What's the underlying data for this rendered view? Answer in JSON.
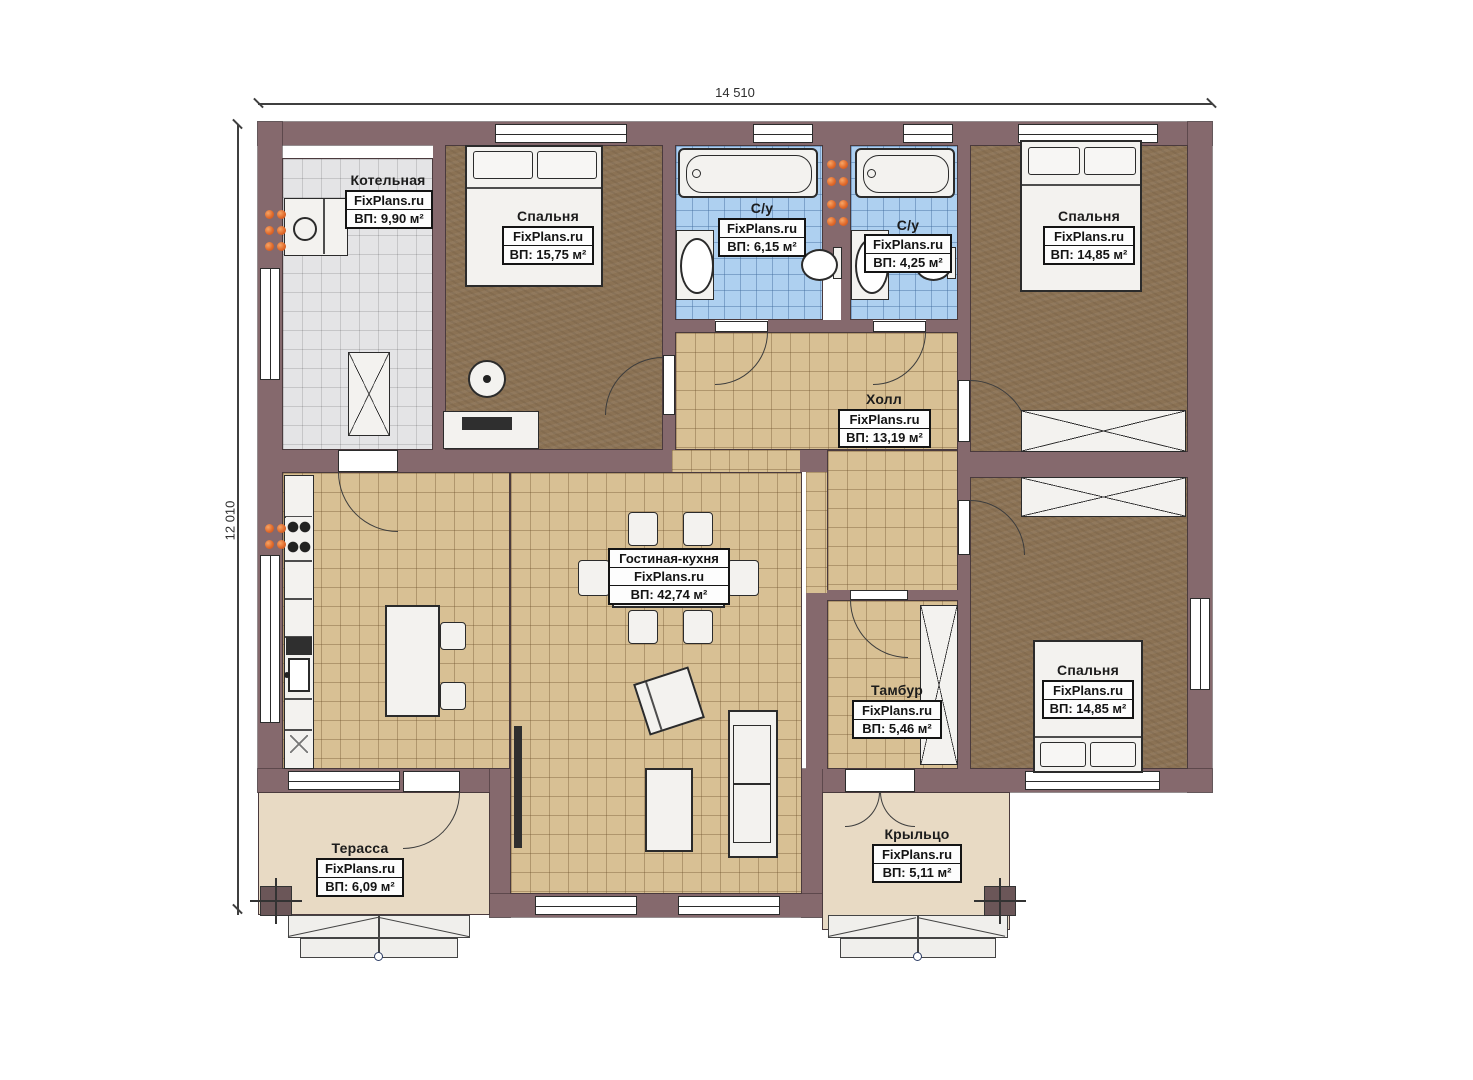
{
  "plan": {
    "dim_width": "14 510",
    "dim_height": "12 010"
  },
  "rooms": {
    "boiler": {
      "name": "Котельная",
      "brand": "FixPlans.ru",
      "area": "ВП: 9,90 м²"
    },
    "bedroom1": {
      "name": "Спальня",
      "brand": "FixPlans.ru",
      "area": "ВП: 15,75 м²"
    },
    "bath1": {
      "name": "С/у",
      "brand": "FixPlans.ru",
      "area": "ВП: 6,15 м²"
    },
    "bath2": {
      "name": "С/у",
      "brand": "FixPlans.ru",
      "area": "ВП: 4,25 м²"
    },
    "bedroom2": {
      "name": "Спальня",
      "brand": "FixPlans.ru",
      "area": "ВП: 14,85 м²"
    },
    "hall": {
      "name": "Холл",
      "brand": "FixPlans.ru",
      "area": "ВП: 13,19 м²"
    },
    "living": {
      "name": "Гостиная-кухня",
      "brand": "FixPlans.ru",
      "area": "ВП: 42,74 м²"
    },
    "vestibule": {
      "name": "Тамбур",
      "brand": "FixPlans.ru",
      "area": "ВП: 5,46 м²"
    },
    "bedroom3": {
      "name": "Спальня",
      "brand": "FixPlans.ru",
      "area": "ВП: 14,85 м²"
    },
    "terrace": {
      "name": "Терасса",
      "brand": "FixPlans.ru",
      "area": "ВП: 6,09 м²"
    },
    "porch": {
      "name": "Крыльцо",
      "brand": "FixPlans.ru",
      "area": "ВП: 5,11 м²"
    }
  },
  "colors": {
    "wall": "#85696d",
    "tile_beige": "#d8c094",
    "tile_blue": "#aed0f0",
    "tile_gray": "#e4e4e6",
    "floor_brown": "#8b7254",
    "deck": "#e8dac4",
    "radiator_orange": "#e06a2b"
  }
}
